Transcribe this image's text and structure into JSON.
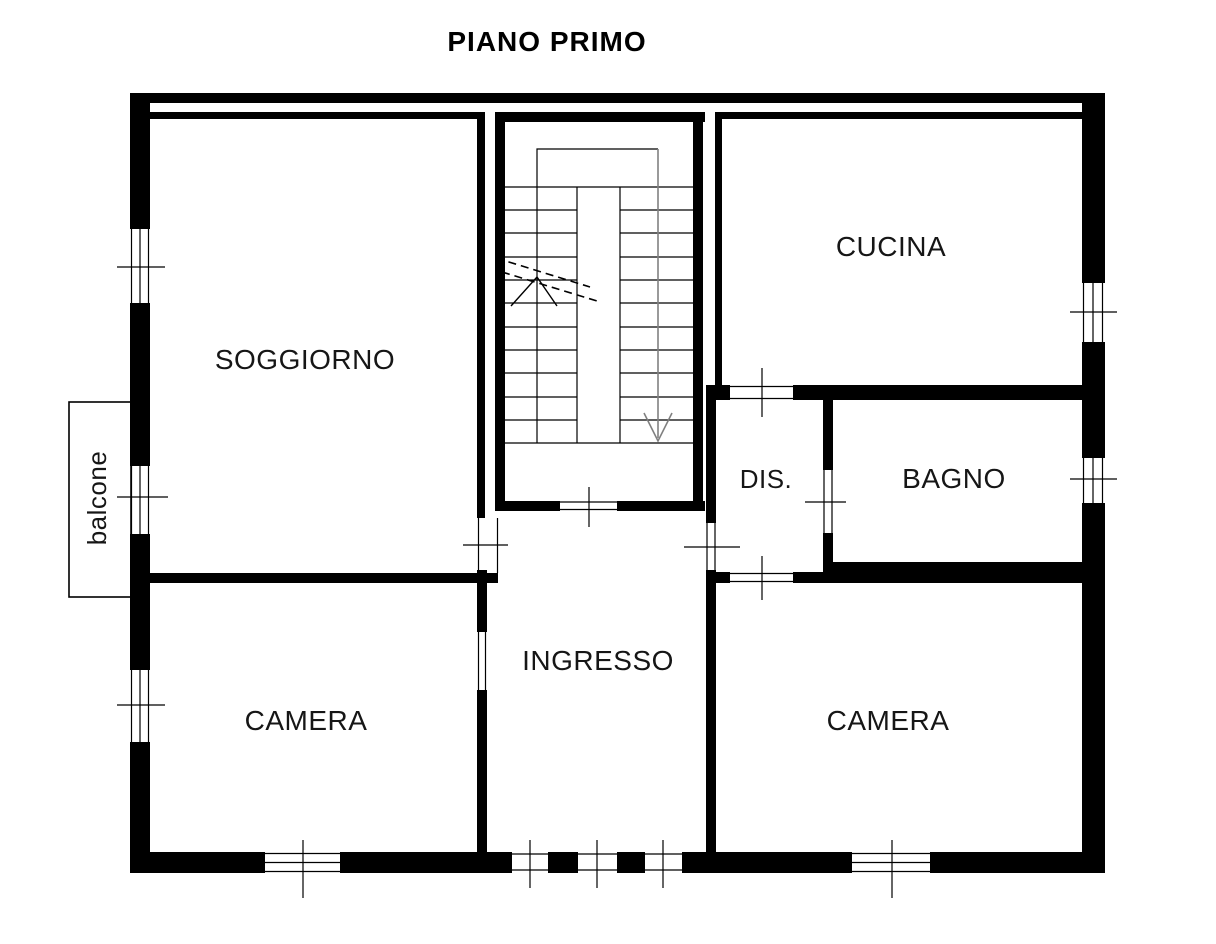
{
  "title": "PIANO PRIMO",
  "rooms": {
    "soggiorno": "SOGGIORNO",
    "cucina": "CUCINA",
    "dis": "DIS.",
    "bagno": "BAGNO",
    "ingresso": "INGRESSO",
    "camera_left": "CAMERA",
    "camera_right": "CAMERA",
    "balcone": "balcone"
  },
  "symbols": {
    "stair_direction_arrow": "down-arrow",
    "stair_break_line": "double-dashed-diagonal",
    "window_symbol": "triple-line-with-tick",
    "door_opening_symbol": "double-line-with-tick"
  },
  "colors": {
    "wall": "#000000",
    "thin_line": "#000000",
    "stair_arrow": "#808080",
    "background": "#ffffff"
  }
}
